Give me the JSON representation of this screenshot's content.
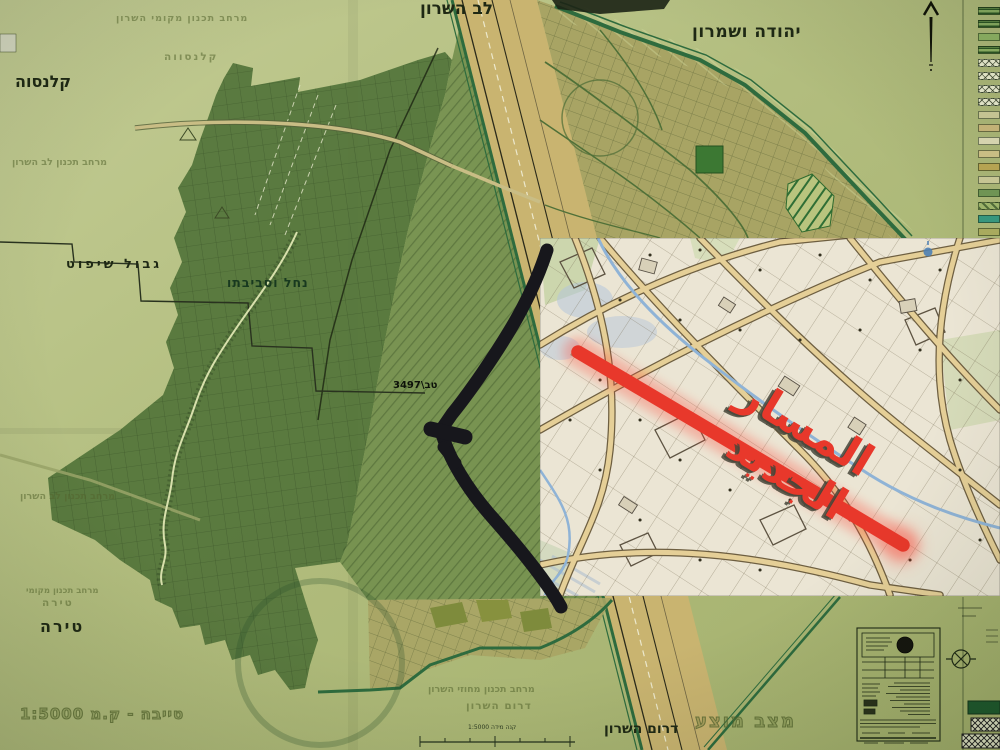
{
  "labels": {
    "lev_hasharon": "לב השרון",
    "yehuda_veshomron": "יהודה ושמרון",
    "qalansawe": "קלנסוה",
    "gvul_shiput": "גבול שיפוט",
    "nahal_usvivato": "נחל וסביבתו",
    "plan_number": "טב\\3497",
    "tira": "טירה",
    "drom_hasharon": "דרום השרון",
    "scale_note": "טייבה - ק.מ 1:5000",
    "scale_caption": "קנה מידה 1:5000"
  },
  "watermarks": {
    "w1": "מרחב תכנון מקומי השרון",
    "w2": "קלנסווה",
    "w3": "מרחב תכנון לב השרון",
    "w4": "מרחב תכנון לב השרון",
    "w5": "מרחב תכנון מקומי",
    "w6": "טירה",
    "w7": "מרחב תכנון מחוזי השרון",
    "w8": "דרום השרון",
    "w9": "מצב מוצע"
  },
  "inset": {
    "route_label": "المسار الجديد",
    "route_color": "#f23b2e"
  },
  "icons": {
    "north_arrow": "north-arrow-icon",
    "seal": "round-seal-icon",
    "survey_mark": "circle-x-survey-icon"
  },
  "colors": {
    "paper": "#b3bd80",
    "dark_green": "#53743a",
    "medium_green": "#6e8c4a",
    "corridor_tan": "#c9b470",
    "town_olive": "#a8a464",
    "boundary_green": "#2e6b3e",
    "route_black": "#17171c",
    "accent_red": "#e8382b",
    "inset_cream": "#ebe5d4",
    "stream_blue": "#8fb3d6"
  },
  "legend": {
    "items": [
      {
        "color": "#7da05a",
        "pattern": "stripes"
      },
      {
        "color": "#7da05a",
        "pattern": "stripes"
      },
      {
        "color": "#85a85e",
        "pattern": "solid"
      },
      {
        "color": "#85a85e",
        "pattern": "stripes"
      },
      {
        "color": "#dde0c4",
        "pattern": "crosshatch"
      },
      {
        "color": "#dde0c4",
        "pattern": "crosshatch"
      },
      {
        "color": "#dde0c4",
        "pattern": "crosshatch"
      },
      {
        "color": "#dde0c4",
        "pattern": "crosshatch"
      },
      {
        "color": "#c4c392",
        "pattern": "solid"
      },
      {
        "color": "#c2b176",
        "pattern": "solid"
      },
      {
        "color": "#d5d3ae",
        "pattern": "solid"
      },
      {
        "color": "#c9bd84",
        "pattern": "solid"
      },
      {
        "color": "#b5a352",
        "pattern": "solid"
      },
      {
        "color": "#c6c594",
        "pattern": "solid"
      },
      {
        "color": "#6f9454",
        "pattern": "solid"
      },
      {
        "color": "#9db36a",
        "pattern": "diag"
      },
      {
        "color": "#37967e",
        "pattern": "solid"
      },
      {
        "color": "#a9aa5e",
        "pattern": "solid"
      }
    ]
  }
}
